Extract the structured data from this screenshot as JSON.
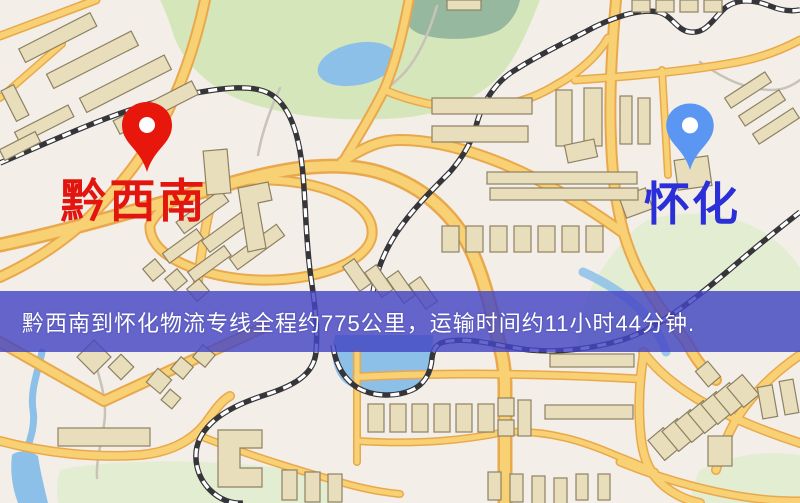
{
  "markers": {
    "origin": {
      "label": "黔西南",
      "pin_color": "#e8170c",
      "label_color": "#e2160e"
    },
    "destination": {
      "label": "怀化",
      "pin_color": "#5b97f2",
      "label_color": "#2a2fd8"
    }
  },
  "banner": {
    "text": "黔西南到怀化物流专线全程约775公里，运输时间约11小时44分钟.",
    "distance_text": "约775公里",
    "duration_text": "约11小时44分钟",
    "bg_color": "rgba(68,70,196,0.82)",
    "text_color": "#ffffff"
  },
  "theme": {
    "background": "#f3efe8",
    "park_green": "#d6e6bb",
    "park_dark": "#7fa894",
    "pale_green": "#e3edd2",
    "water_blue": "#8cc0e9",
    "road_casing": "#eaa84d",
    "road_fill": "#f7d173",
    "rail_dark": "#35353a",
    "rail_dash": "#ffffff",
    "building_fill": "#e9debb",
    "building_stroke": "#8d8163",
    "path_grey": "#c8c2b8"
  }
}
